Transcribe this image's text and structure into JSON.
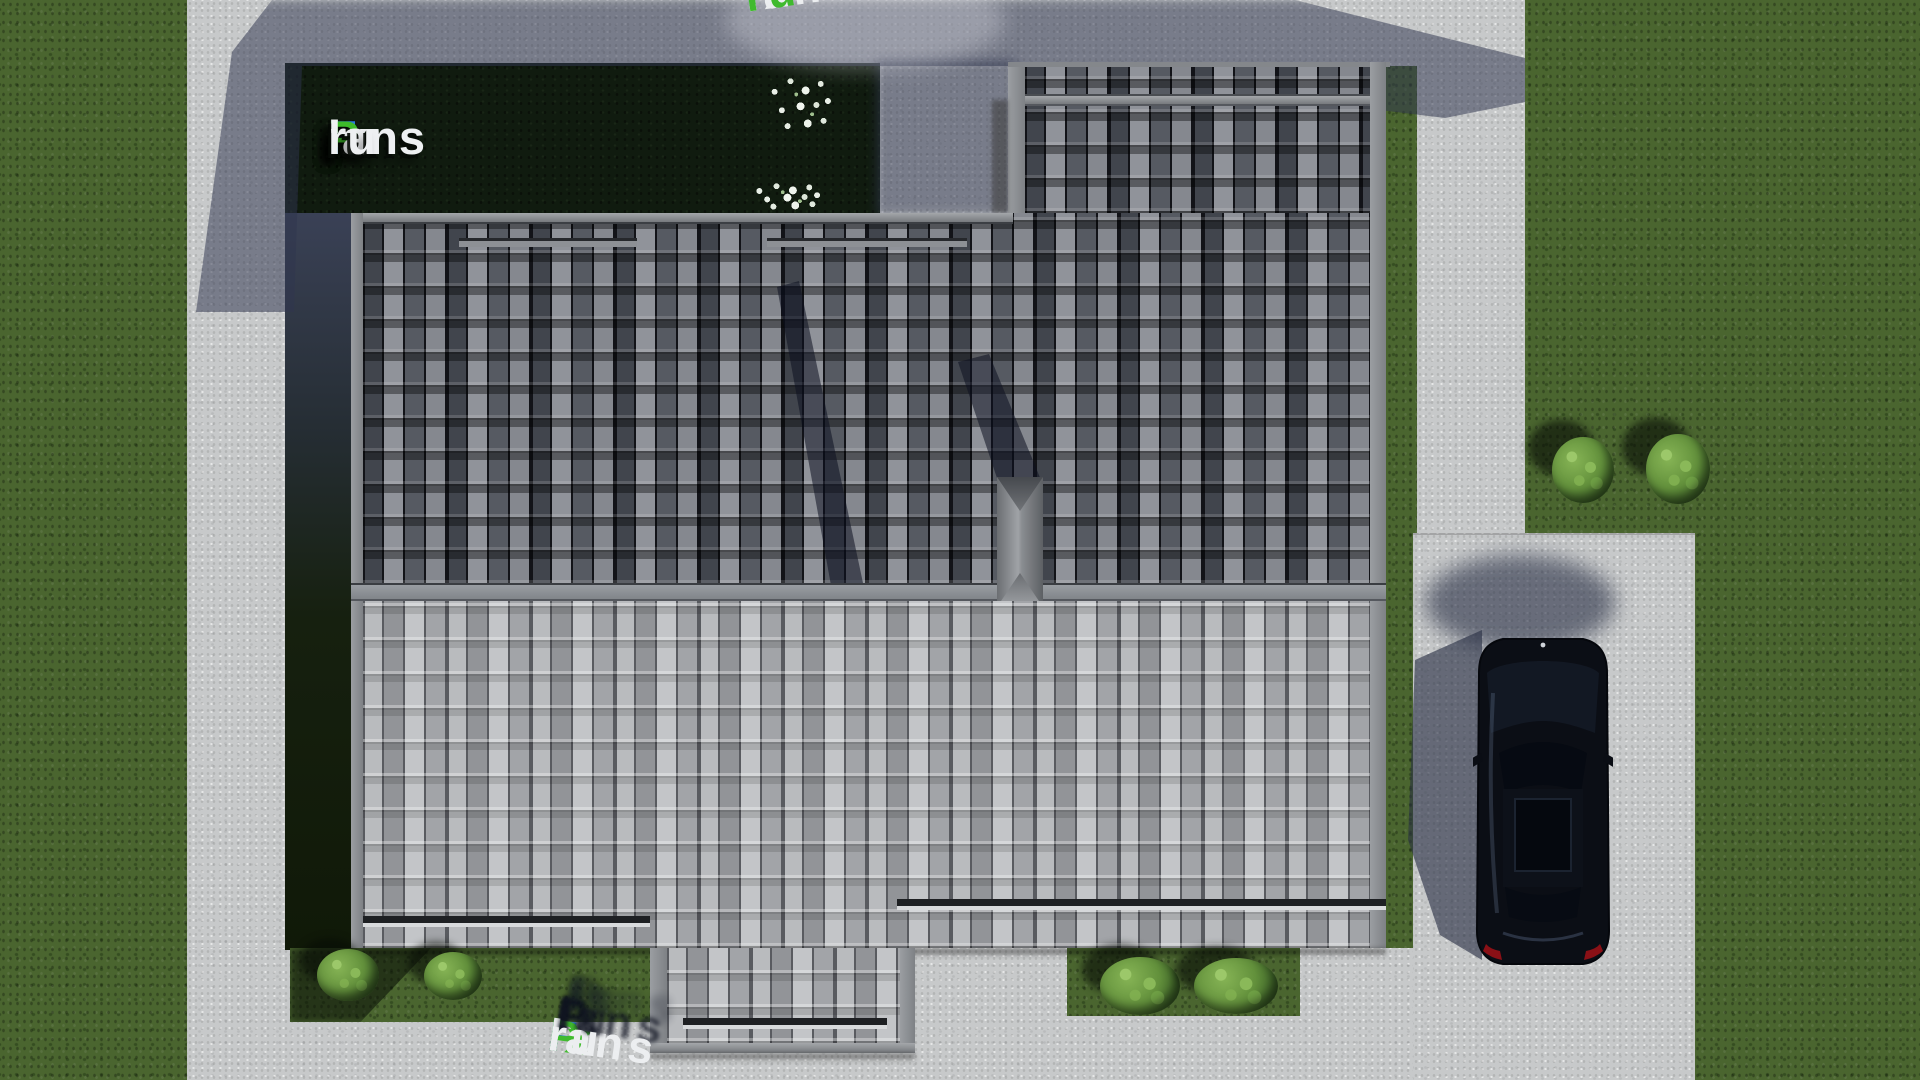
{
  "brand": {
    "full_text": "FixPlans.ru",
    "logo": {
      "f": "F",
      "ix": "ix",
      "p": "P",
      "lans": "lans",
      "dot": ".",
      "ru": "ru"
    }
  },
  "palette": {
    "brand_blue": "#2a7de1",
    "brand_green": "#3dbb2a",
    "text_white": "#eef0f2",
    "grass_green": "#4a652f",
    "lawn_dark_green": "#101b0f",
    "concrete_gray": "#c7c9ca",
    "roof_dark_gray": "#33363d",
    "roof_light_gray": "#a7a9ad",
    "car_body_black": "#0b0e15",
    "taillight_red": "#8a1016"
  }
}
